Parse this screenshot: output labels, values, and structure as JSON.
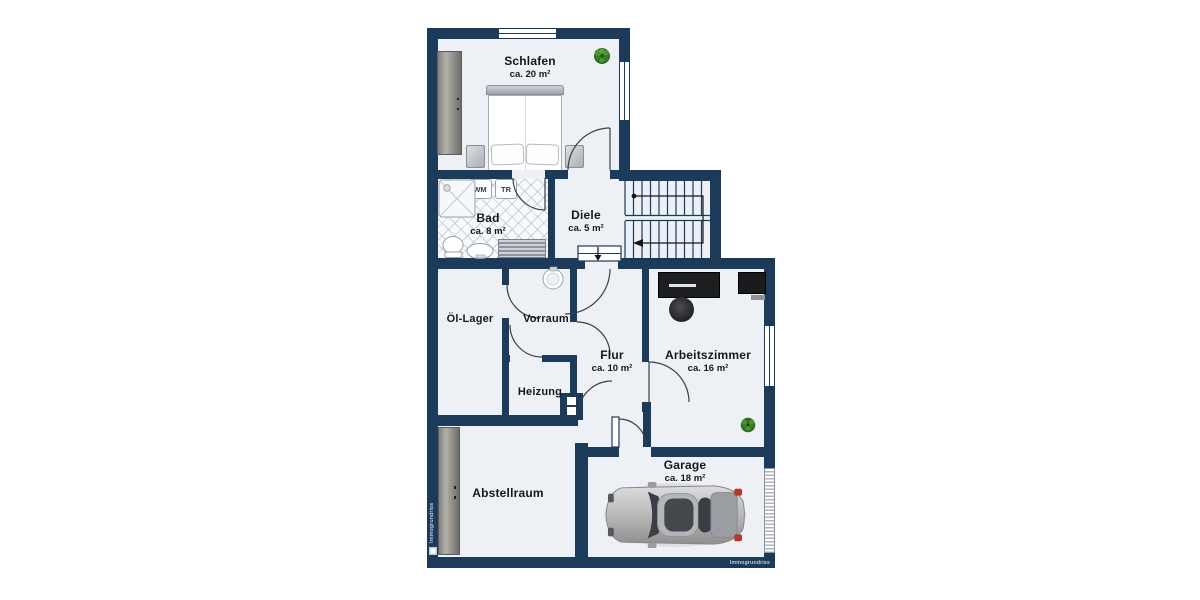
{
  "plan": {
    "type": "floor-plan",
    "language": "de",
    "watermark": {
      "bottom": "Immogrundriss",
      "side": "Immogrundriss"
    }
  },
  "rooms": {
    "schlafen": {
      "name": "Schlafen",
      "area": "ca. 20 m²"
    },
    "bad": {
      "name": "Bad",
      "area": "ca. 8 m²"
    },
    "diele": {
      "name": "Diele",
      "area": "ca. 5 m²"
    },
    "oel_lager": {
      "name": "Öl-Lager"
    },
    "vorraum": {
      "name": "Vorraum"
    },
    "flur": {
      "name": "Flur",
      "area": "ca. 10 m²"
    },
    "arbeitszimmer": {
      "name": "Arbeitszimmer",
      "area": "ca. 16 m²"
    },
    "heizung": {
      "name": "Heizung"
    },
    "abstellraum": {
      "name": "Abstellraum"
    },
    "garage": {
      "name": "Garage",
      "area": "ca. 18 m²"
    }
  },
  "appliances": {
    "washing_machine": "WM",
    "dryer": "TR"
  },
  "colors": {
    "wall": "#1c3a5a",
    "floor": "#edf1f6",
    "plant": "#3c7a2a",
    "taillight": "#b3392f"
  }
}
